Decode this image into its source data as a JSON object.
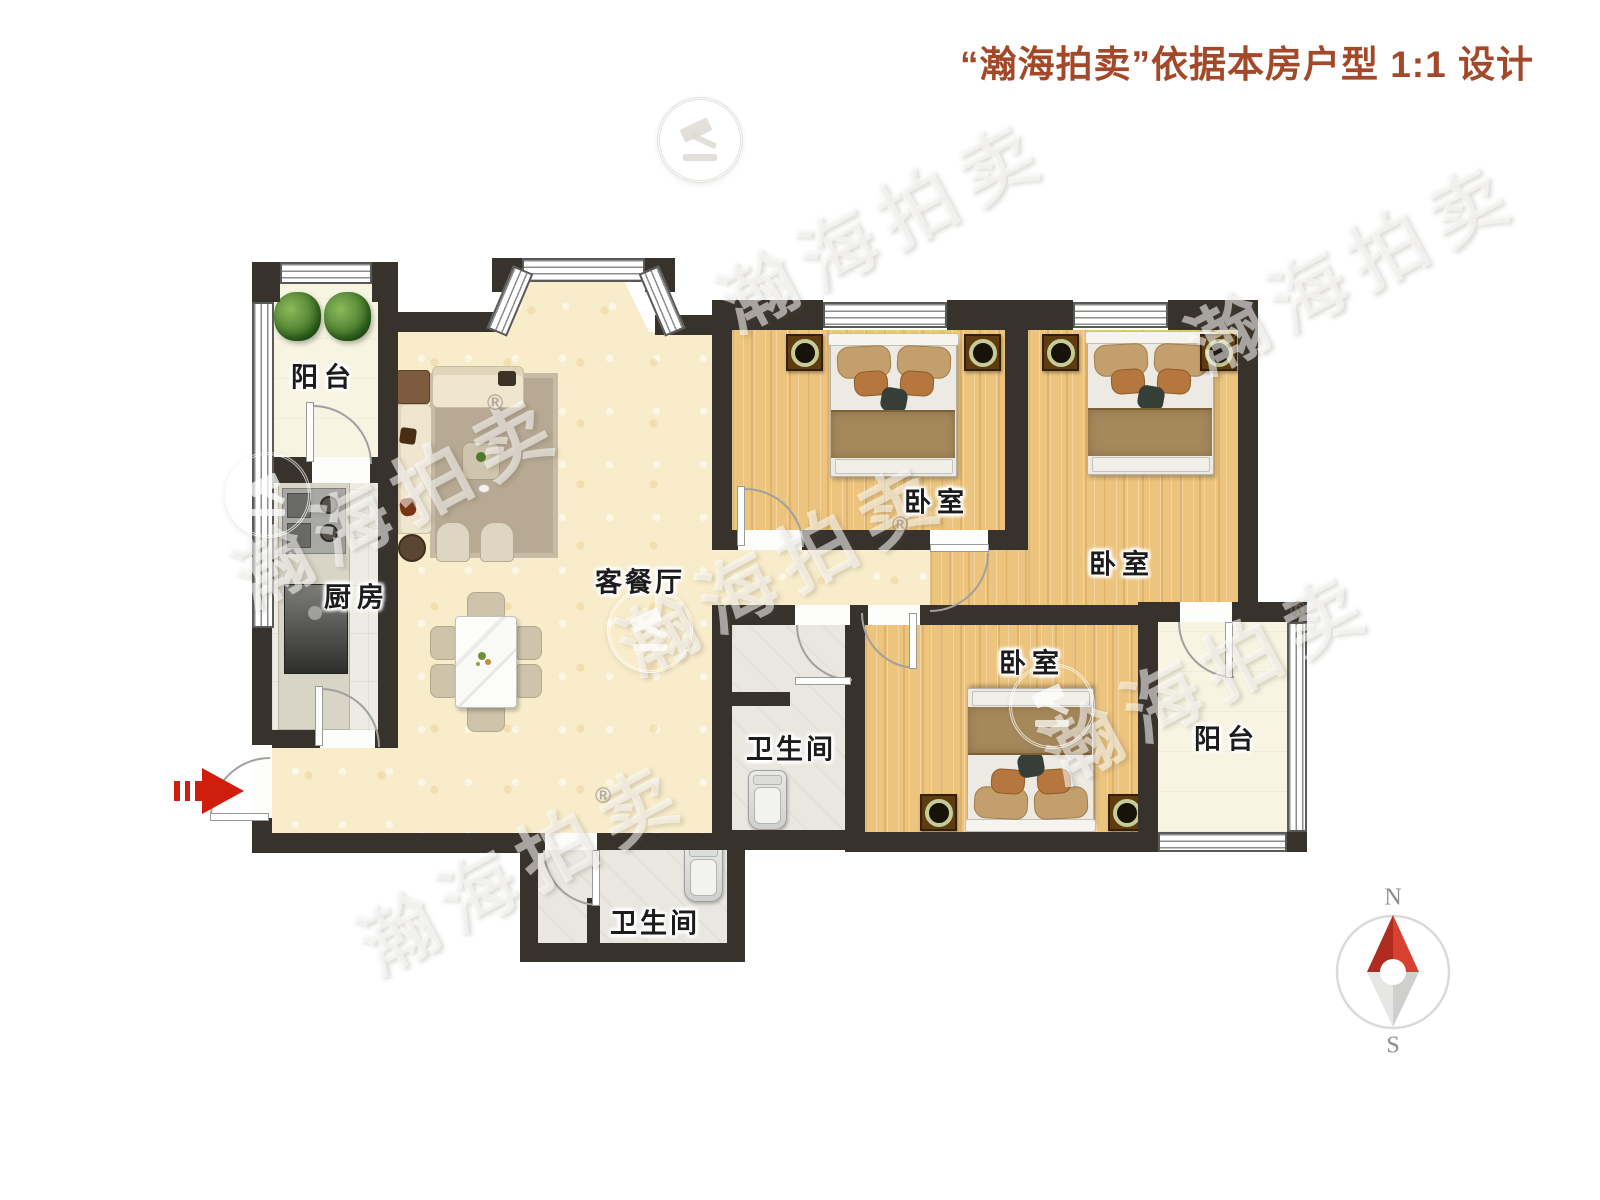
{
  "title": {
    "text": "“瀚海拍卖”依据本房户型 1:1 设计",
    "color": "#a3492a"
  },
  "rooms": {
    "balcony": "阳台",
    "kitchen": "厨房",
    "living_dining": "客餐厅",
    "bedroom": "卧室",
    "bathroom": "卫生间"
  },
  "compass": {
    "north": "N",
    "south": "S"
  },
  "watermark": {
    "brand": "瀚海拍卖",
    "registered": "®"
  },
  "colors": {
    "wall": "#38322d",
    "floor_living": "#f8ecca",
    "floor_bedroom": "#ecc47e",
    "floor_kitchen": "#edebe4",
    "floor_bathroom": "#e9e7e0",
    "floor_balcony": "#f7f4e2",
    "entry_arrow_red": "#cf1d0e",
    "compass_north_red": "#c8372a",
    "title_red": "#a3492a"
  }
}
